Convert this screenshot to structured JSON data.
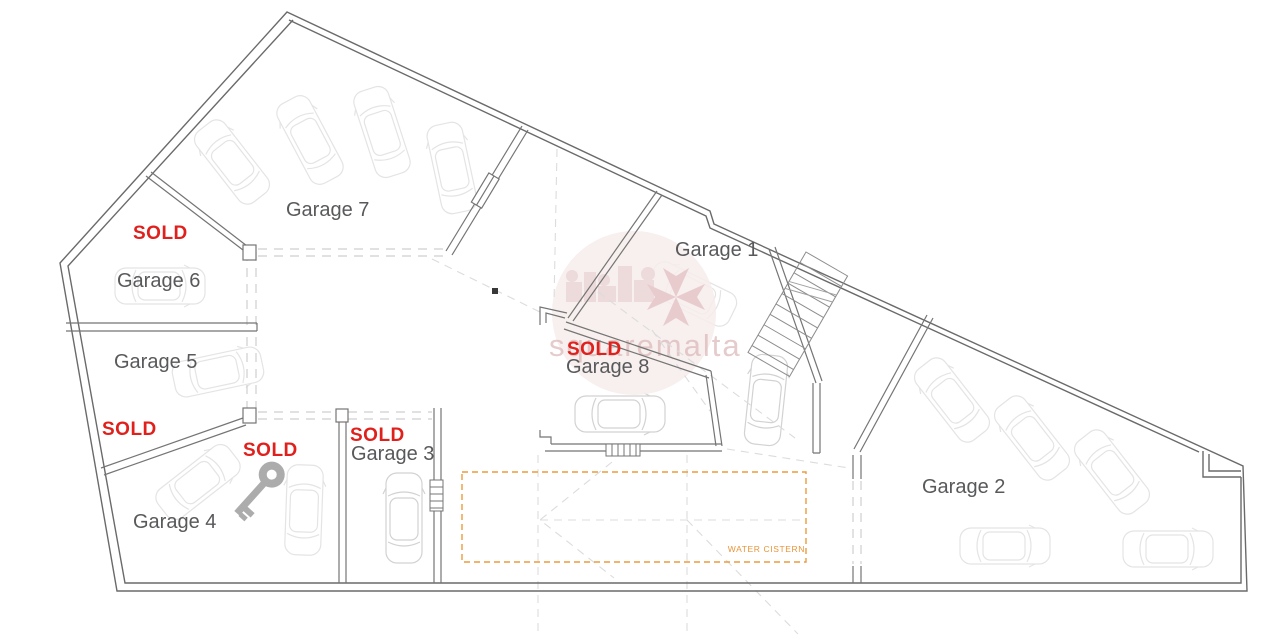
{
  "rooms": [
    {
      "name": "garage-7",
      "label": "Garage 7",
      "sold": ""
    },
    {
      "name": "garage-6",
      "label": "Garage 6",
      "sold": "SOLD"
    },
    {
      "name": "garage-5",
      "label": "Garage 5",
      "sold": "SOLD"
    },
    {
      "name": "garage-4",
      "label": "Garage 4",
      "sold": "SOLD"
    },
    {
      "name": "garage-3",
      "label": "Garage 3",
      "sold": "SOLD"
    },
    {
      "name": "garage-8",
      "label": "Garage 8",
      "sold": "SOLD"
    },
    {
      "name": "garage-1",
      "label": "Garage 1",
      "sold": ""
    },
    {
      "name": "garage-2",
      "label": "Garage 2",
      "sold": ""
    }
  ],
  "annotations": {
    "water_cistern": "WATER CISTERN"
  },
  "watermark": {
    "text": "squaremalta"
  },
  "colors": {
    "sold_red": "#e0201c",
    "cistern_orange": "#e8943a",
    "label_gray": "#58595b",
    "wall_gray": "#6a6a6a",
    "dash_gray": "#cfcfcf",
    "car_gray": "#e4e4e4",
    "watermark_pink": "#f7ecec"
  }
}
